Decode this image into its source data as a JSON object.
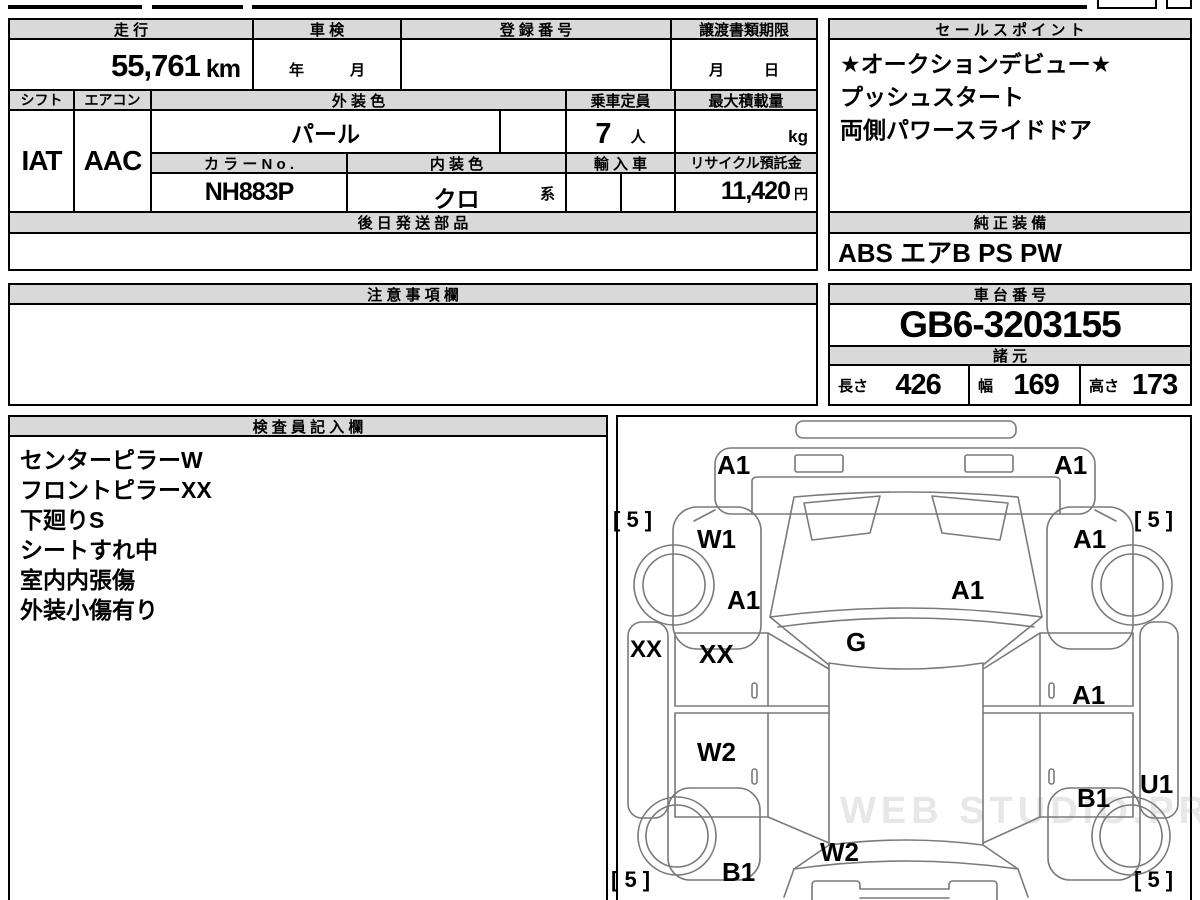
{
  "table": {
    "mileage": {
      "header": "走 行",
      "value": "55,761",
      "unit": "km"
    },
    "inspection": {
      "header": "車 検",
      "year_label": "年",
      "month_label": "月"
    },
    "registration": {
      "header": "登 録 番 号",
      "value": ""
    },
    "transfer_deadline": {
      "header": "譲渡書類期限",
      "month_label": "月",
      "day_label": "日"
    },
    "shift": {
      "header": "シフト",
      "value": "IAT"
    },
    "aircon": {
      "header": "エアコン",
      "value": "AAC"
    },
    "exterior_color": {
      "header": "外 装 色",
      "value": "パール"
    },
    "capacity": {
      "header": "乗車定員",
      "value": "7",
      "unit": "人"
    },
    "max_load": {
      "header": "最大積載量",
      "value": "",
      "unit": "kg"
    },
    "color_no": {
      "header": "カ ラ ー N o .",
      "value": "NH883P"
    },
    "interior_color": {
      "header": "内 装 色",
      "value": "クロ",
      "suffix": "系"
    },
    "imported": {
      "header": "輸 入 車",
      "value": ""
    },
    "recycle_deposit": {
      "header": "リサイクル預託金",
      "value": "11,420",
      "unit": "円"
    },
    "later_shipped_parts": {
      "header": "後 日 発 送 部 品",
      "value": ""
    }
  },
  "sales_points": {
    "header": "セ ー ル ス ポ イ ン ト",
    "lines": [
      "★オークションデビュー★",
      "プッシュスタート",
      "両側パワースライドドア"
    ]
  },
  "genuine_equipment": {
    "header": "純 正 装 備",
    "value": "ABS エアB PS PW"
  },
  "notes": {
    "header": "注 意 事 項 欄",
    "value": ""
  },
  "chassis_no": {
    "header": "車 台 番 号",
    "value": "GB6-3203155"
  },
  "specs": {
    "header": "諸 元",
    "length_label": "長さ",
    "length": "426",
    "width_label": "幅",
    "width": "169",
    "height_label": "高さ",
    "height": "173"
  },
  "inspector_notes": {
    "header": "検 査 員 記 入 欄",
    "lines": [
      "センターピラーW",
      "フロントピラーXX",
      "下廻りS",
      "シートすれ中",
      "室内内張傷",
      "外装小傷有り"
    ]
  },
  "diagram": {
    "labels": [
      {
        "area": "front-bumper-left",
        "text": "A1"
      },
      {
        "area": "front-bumper-right",
        "text": "A1"
      },
      {
        "area": "tire-front-left",
        "text": "[ 5 ]"
      },
      {
        "area": "tire-front-right",
        "text": "[ 5 ]"
      },
      {
        "area": "front-fender-left",
        "text": "W1"
      },
      {
        "area": "front-fender-right",
        "text": "A1"
      },
      {
        "area": "cowl-left",
        "text": "A1"
      },
      {
        "area": "windshield",
        "text": "A1"
      },
      {
        "area": "sill-left",
        "text": "XX"
      },
      {
        "area": "front-door-left",
        "text": "XX"
      },
      {
        "area": "roof",
        "text": "G"
      },
      {
        "area": "front-door-right",
        "text": "A1"
      },
      {
        "area": "rear-door-left",
        "text": "W2"
      },
      {
        "area": "rear-door-right",
        "text": "B1"
      },
      {
        "area": "sill-right",
        "text": "U1"
      },
      {
        "area": "rear-fender-left",
        "text": "B1"
      },
      {
        "area": "rear-hatch",
        "text": "W2"
      },
      {
        "area": "tire-rear-left",
        "text": "[ 5 ]"
      },
      {
        "area": "tire-rear-right",
        "text": "[ 5 ]"
      }
    ],
    "watermark": "WEB STUDIO.PRO"
  },
  "colors": {
    "header_bg": "#d9d9d9",
    "border": "#000000",
    "car_outline": "#7a7a7a"
  }
}
